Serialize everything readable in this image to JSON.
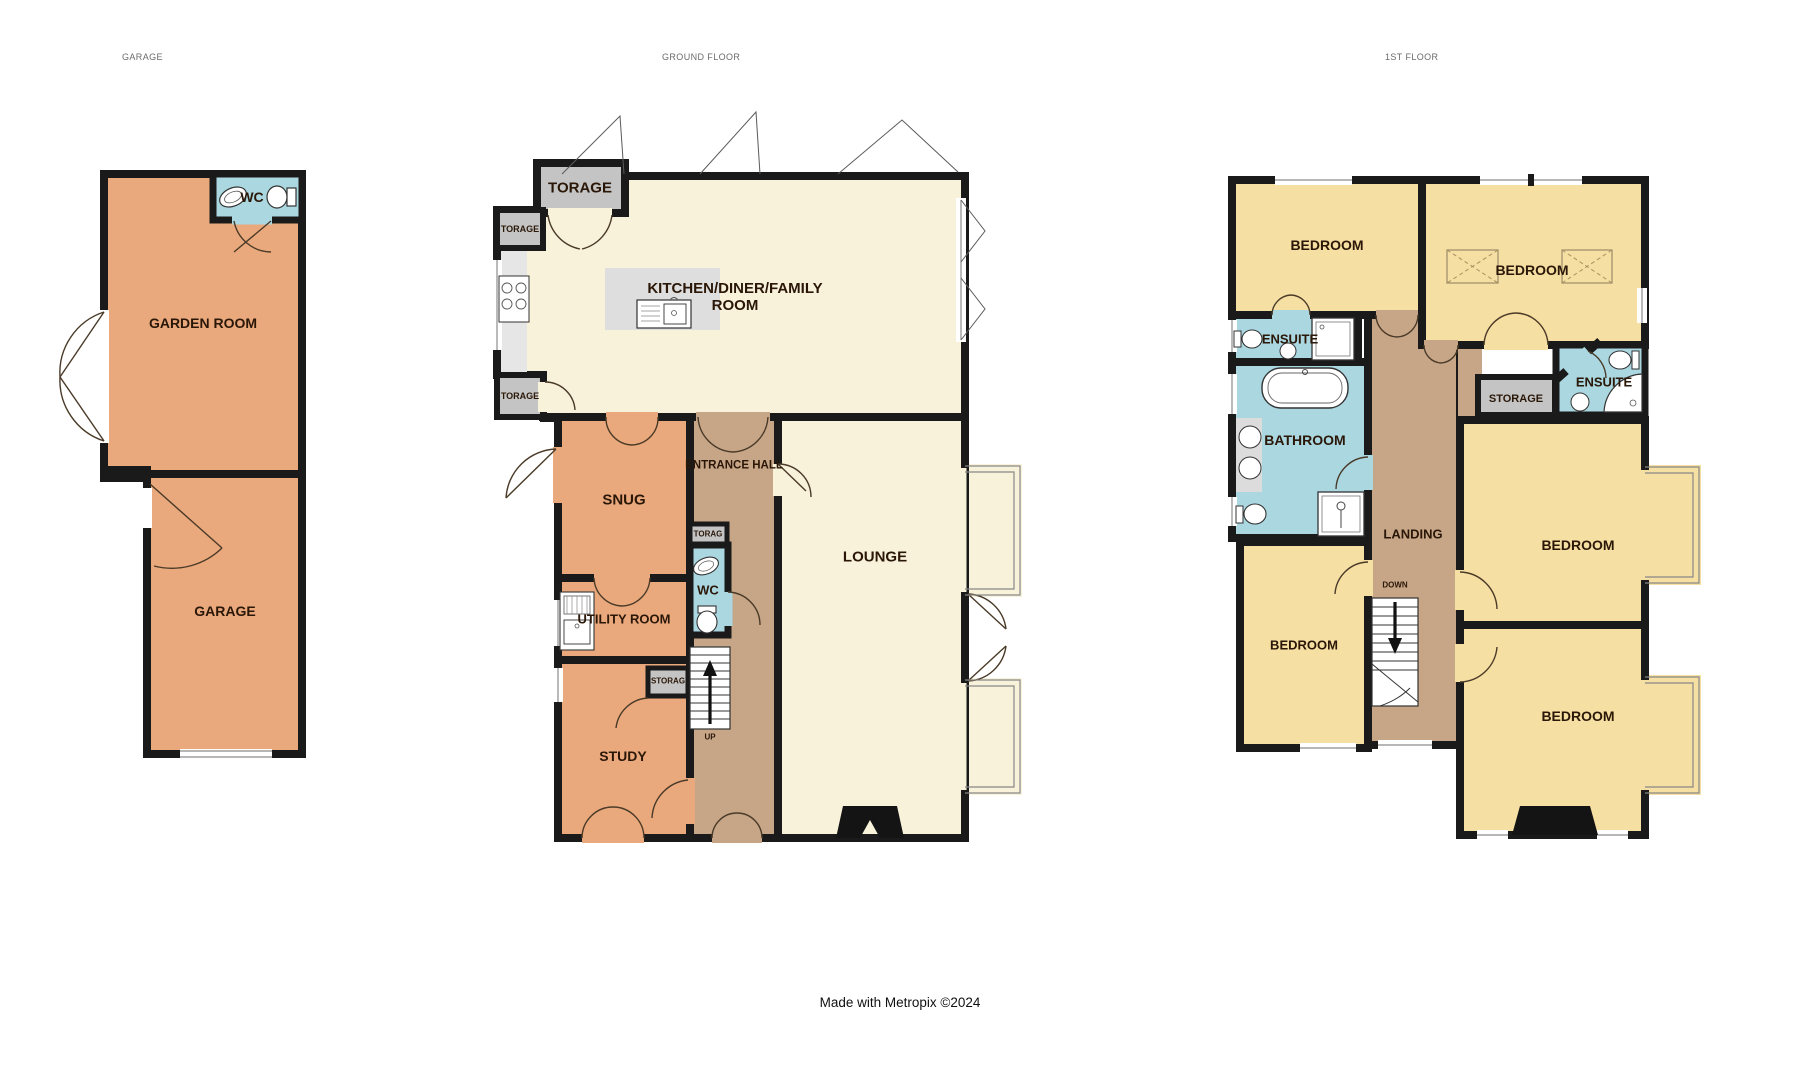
{
  "titles": {
    "garage": "GARAGE",
    "ground": "GROUND FLOOR",
    "first": "1ST FLOOR"
  },
  "footer": "Made with Metropix ©2024",
  "garage_building": {
    "garden_room": "GARDEN ROOM",
    "wc": "WC",
    "garage": "GARAGE"
  },
  "ground_floor": {
    "storage_top": "TORAGE",
    "storage_upper": "TORAGE",
    "storage_lower": "TORAGE",
    "kitchen": "KITCHEN/DINER/FAMILY ROOM",
    "snug": "SNUG",
    "entrance_hall": "ENTRANCE HALL",
    "lounge": "LOUNGE",
    "wc": "WC",
    "storage_hall": "TORAG",
    "utility": "UTILITY ROOM",
    "storage_stairs": "STORAG",
    "study": "STUDY",
    "stairs_dir": "UP"
  },
  "first_floor": {
    "bedroom_nw": "BEDROOM",
    "bedroom_ne": "BEDROOM",
    "ensuite_w": "ENSUITE",
    "bathroom": "BATHROOM",
    "storage": "STORAGE",
    "ensuite_e": "ENSUITE",
    "landing": "LANDING",
    "stairs_dir": "DOWN",
    "bedroom_e": "BEDROOM",
    "bedroom_sw": "BEDROOM",
    "bedroom_se": "BEDROOM"
  },
  "colors": {
    "room_orange": "#eaa97c",
    "room_cream": "#f8f2da",
    "room_yellow": "#f6dfa2",
    "room_blue": "#abd7e1",
    "hall_brown": "#c7a687",
    "storage_gray": "#c4c4c4",
    "counter_gray": "#e6e6e6",
    "wall_black": "#1a1a1a"
  }
}
